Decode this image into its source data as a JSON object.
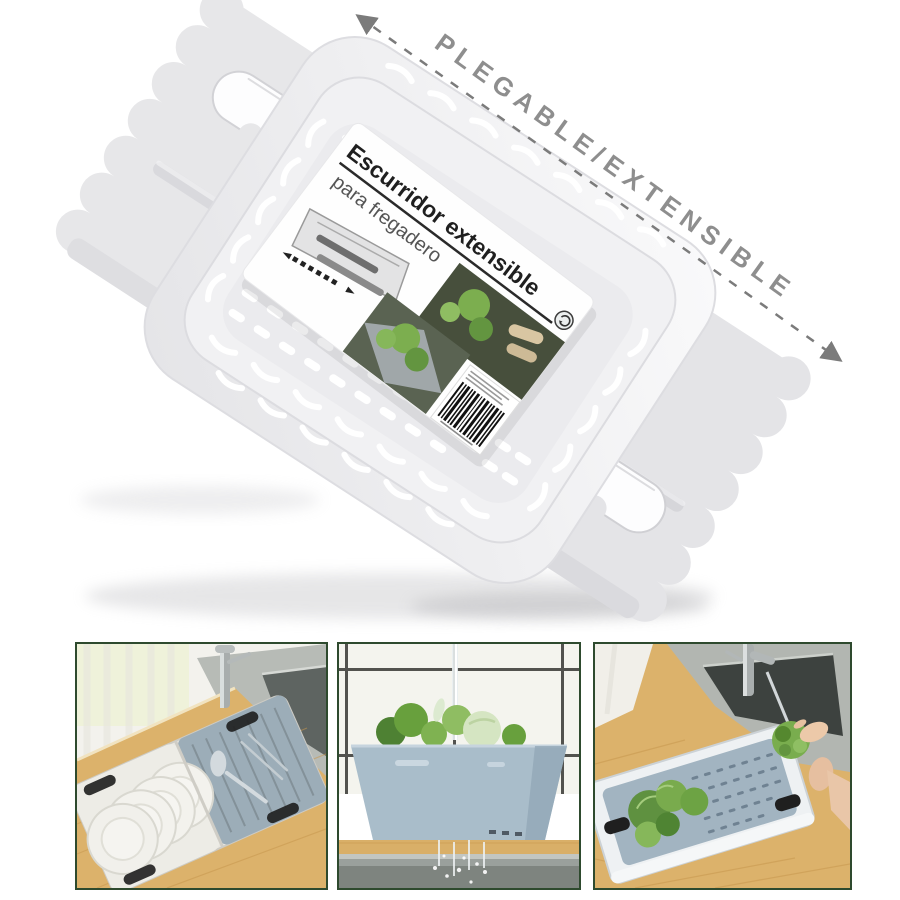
{
  "page": {
    "background": "#ffffff"
  },
  "hero": {
    "annotation": {
      "label": "PLEGABLE/EXTENSIBLE",
      "text_color": "#8e8e8e",
      "line_color": "#7b7b7b"
    },
    "product": {
      "name": "escurridor extensible blanco",
      "body_color": "#e9e9eb",
      "basket_color": "#f1f1f3",
      "label": {
        "title": "Escurridor extensible",
        "subtitle": "para fregadero",
        "title_color": "#1f1f1f",
        "subtitle_color": "#555555"
      }
    }
  },
  "gallery": {
    "frame_color": "#2e4a2e",
    "scenes": [
      {
        "name": "drainer with plates and cutlery over sink"
      },
      {
        "name": "blue basin draining water over sink"
      },
      {
        "name": "rinsing lettuce in extended drainer"
      }
    ],
    "palette": {
      "wood": "#dcb26b",
      "steel": "#b2b6b1",
      "basin_blue": "#a9bdca",
      "lettuce_green": "#68a03d",
      "plate_white": "#f3f2ed"
    }
  }
}
